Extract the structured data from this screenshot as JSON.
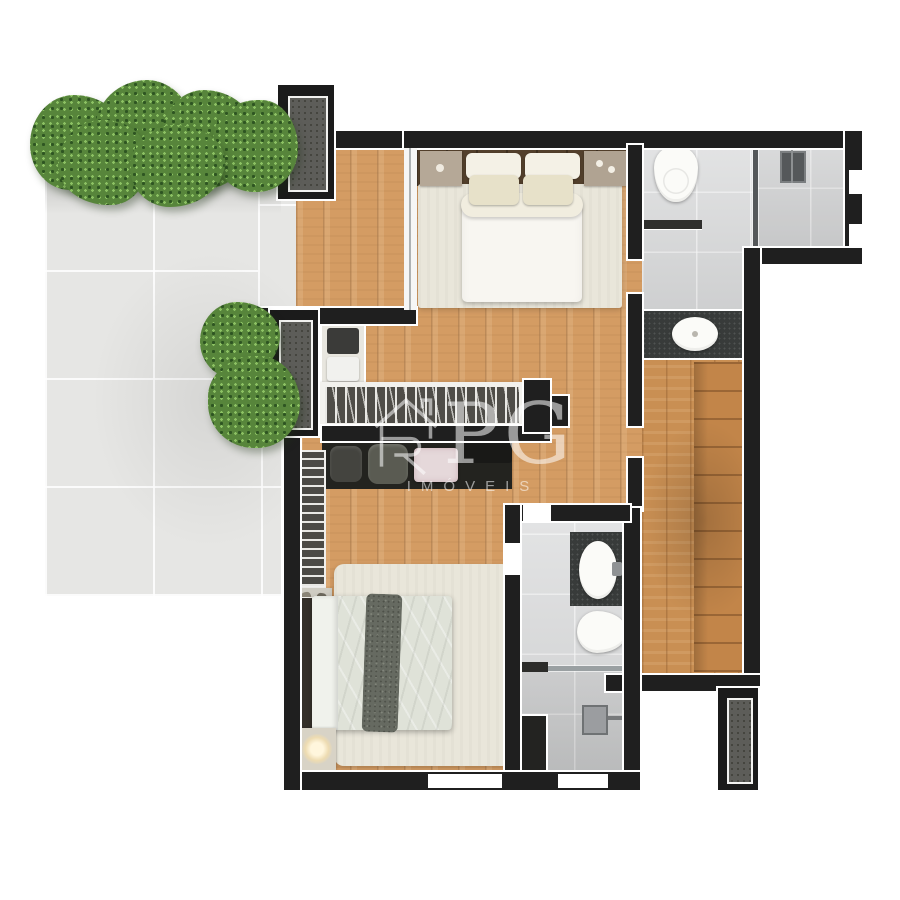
{
  "watermark": {
    "logo_text": "PG",
    "logo_icon": "house-r-icon",
    "subtitle": "IMÓVEIS",
    "color": "#ffffff",
    "opacity": "0.55"
  },
  "plan": {
    "type": "apartment-floor-plan-top-view",
    "features": [
      "terrace-with-tile-floor",
      "hedge-plants",
      "terrace-bushes",
      "ac-duct-unit-top",
      "ac-duct-unit-middle",
      "ac-duct-unit-bottom-right",
      "suite1-double-bed",
      "suite1-nightstands",
      "suite1-rug",
      "bathroom1-toilet",
      "bathroom1-shower",
      "vanity-sink-granite-counter",
      "walk-in-closet-cabinets",
      "hanging-clothes-rack-long",
      "hanging-clothes-rack-vertical",
      "towel-shelf",
      "storage-bags-shelf",
      "bedroom2-double-bed",
      "bedroom2-fur-throw",
      "bedroom2-rug",
      "bedroom2-lamp",
      "bathroom2-sink",
      "bathroom2-toilet",
      "bathroom2-shower",
      "glass-partitions",
      "window-openings",
      "black-walls-white-keyline"
    ]
  },
  "palette": {
    "background": "#ffffff",
    "wall": "#1f1f1f",
    "wall_outline": "#ffffff",
    "wood_floor": "#d49c63",
    "closet_wood": "#c98f53",
    "terrace_tile": "#e6e6e4",
    "bathroom_tile": "#d9dadb",
    "granite_counter": "#383b3a",
    "plant_green": "#57853b",
    "plant_green_dark": "#2e5522",
    "equipment_gray": "#5d5d59",
    "bedding_white": "#f8f6f1",
    "bedding_sage": "#dfe2d8",
    "fur_throw": "#666a61",
    "rug": "#e9e6da",
    "headboard_wood": "#53402c"
  }
}
